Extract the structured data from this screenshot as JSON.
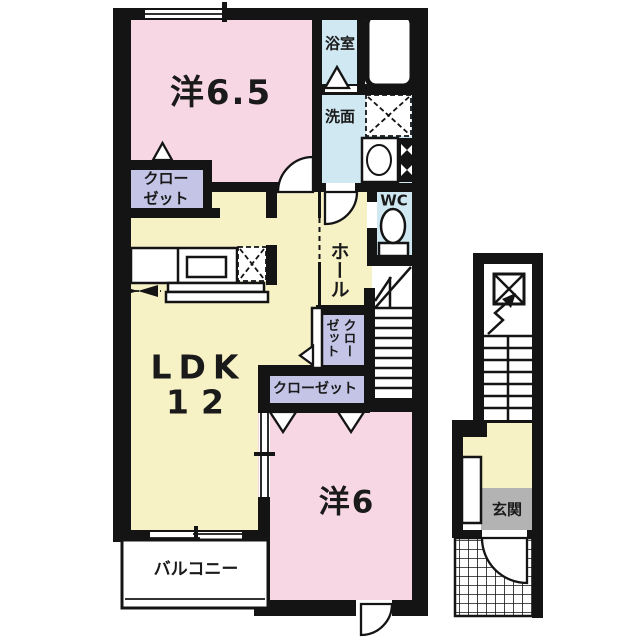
{
  "title": "2LDK apartment floor plan",
  "colors": {
    "room_pink": "#f7d7e3",
    "room_yellow": "#f7f1c6",
    "room_blue": "#cfe8f1",
    "closet_lavender": "#c4c4e7",
    "entrance_gray": "#b3b3b3",
    "wall_black": "#141414"
  },
  "rooms": {
    "western_6_5": {
      "label": "洋6.5"
    },
    "closet_nw": {
      "line1": "クロー",
      "line2": "ゼット"
    },
    "bathroom": {
      "label": "浴室"
    },
    "washroom": {
      "label": "洗面"
    },
    "wc": {
      "label": "WC"
    },
    "hall": {
      "label": "ホール"
    },
    "closet_hall": {
      "col1": "クロー",
      "col2": "ゼット"
    },
    "closet_south": {
      "label": "クローゼット"
    },
    "ldk": {
      "label": "LDK",
      "size": "12"
    },
    "western_6": {
      "label": "洋6"
    },
    "balcony": {
      "label": "バルコニー"
    },
    "entrance": {
      "label": "玄関"
    }
  },
  "fixtures": {
    "bathtub": "bathtub",
    "washer_pan": "washing-machine-space",
    "washbasin": "washbasin",
    "pipe_space": "pipe-space",
    "toilet": "toilet",
    "kitchen_counter": "kitchen-counter",
    "stove": "kitchen-stove",
    "refrigerator": "refrigerator-space",
    "stairs_upper": "staircase-to-2f",
    "stairs_entry": "entry-staircase",
    "front_door": "front-door",
    "shoe_cabinet": "shoe-cabinet",
    "porch": "tiled-entrance-porch"
  }
}
